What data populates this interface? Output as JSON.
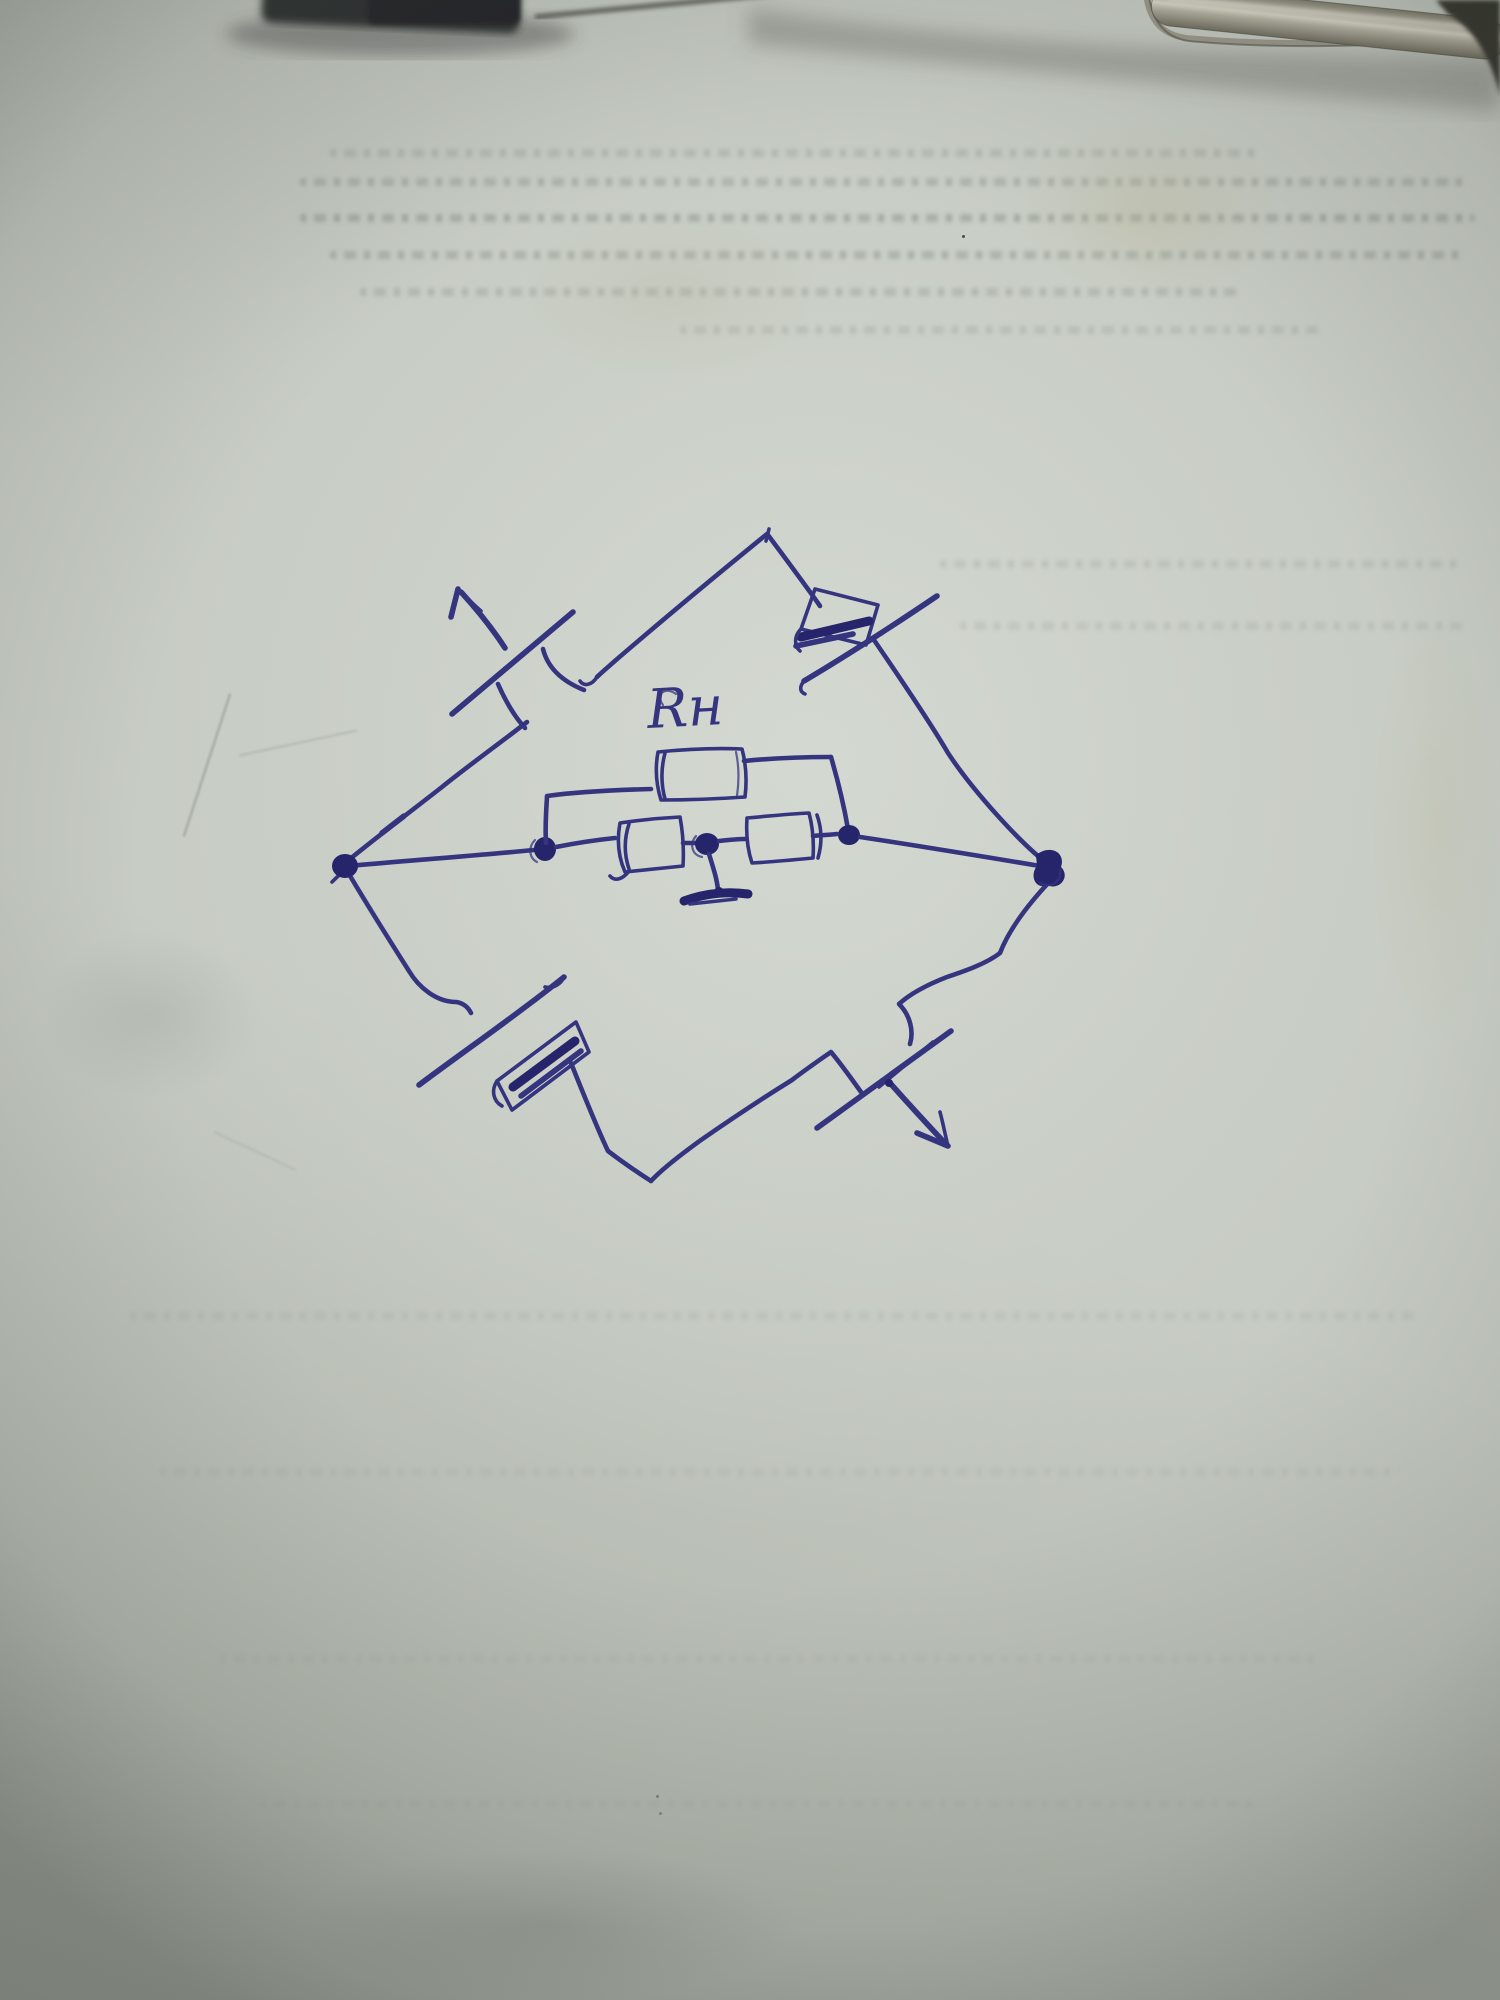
{
  "page": {
    "kind": "photograph of a paper sheet",
    "description": "Hand-drawn electrical bridge circuit sketched in blue ballpoint pen on a greenish-gray notebook page; two clamp/clip objects intrude at the top edge; faint mirrored handwriting bleeds through the paper"
  },
  "colors": {
    "ink": "#35357f",
    "ink-dark": "#26246a",
    "paper": "#c6cbc3",
    "paper-shadow": "#a9aea6",
    "metal-light": "#d9d6c6",
    "metal-dark": "#6f6c5e",
    "clamp": "#2c2d2f"
  },
  "diagram": {
    "type": "circuit-sketch",
    "label": "Rн",
    "shape": "diamond bridge with four outer arms and an inner ladder network",
    "components": [
      "load-resistor-box-labeled-Rн",
      "diode-box-upper-right-arm",
      "diode-box-lower-left-arm",
      "series-box-left",
      "series-box-right",
      "ground-symbol-at-center-node",
      "input-break-with-arrow-upper-left",
      "output-break-with-arrow-lower-right"
    ],
    "arrows": [
      {
        "position": "upper-left",
        "direction": "pointing up-left, outward"
      },
      {
        "position": "lower-right",
        "direction": "pointing down-right, outward"
      },
      {
        "position": "lower-left-slash",
        "direction": "pointing up-right along slash"
      }
    ],
    "nodes": [
      "left-vertex",
      "top-vertex",
      "right-vertex",
      "bottom-vertex",
      "inner-node-1",
      "inner-node-2-grounded",
      "inner-node-3"
    ]
  },
  "scene": {
    "objects": [
      "dark-clamp-top-left",
      "metal-clip-arm-top-right",
      "thin-rod-top-center"
    ],
    "bleed_through_text": "illegible mirrored handwriting rows"
  }
}
